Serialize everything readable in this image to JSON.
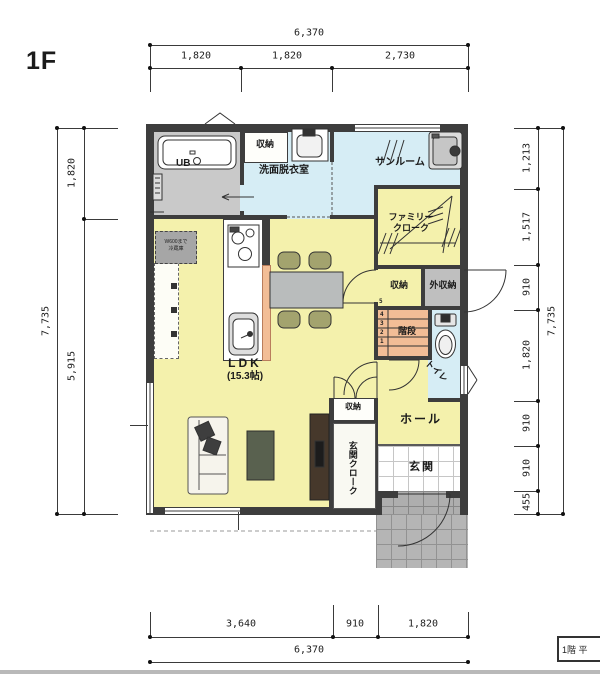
{
  "title": "1F",
  "stamp": "1階 平",
  "dims": {
    "top": {
      "total": "6,370",
      "seg": [
        "1,820",
        "1,820",
        "2,730"
      ]
    },
    "bottom": {
      "total": "6,370",
      "seg": [
        "3,640",
        "910",
        "1,820"
      ]
    },
    "left": {
      "total": "7,735",
      "seg": [
        "1,820",
        "5,915"
      ]
    },
    "right": {
      "total": "7,735",
      "seg": [
        "1,213",
        "1,517",
        "910",
        "1,820",
        "910",
        "910",
        "455"
      ]
    }
  },
  "rooms": {
    "ub": "UB",
    "storage_top": "収納",
    "washroom": "洗面脱衣室",
    "sunroom": "サンルーム",
    "family_cloak": [
      "ファミリー",
      "クローク"
    ],
    "storage_mid": "収納",
    "ext_storage": "外収納",
    "stairs": "階段",
    "toilet": "トイレ",
    "ldk": "LDK",
    "ldk_size": "(15.3帖)",
    "hall": "ホール",
    "entrance": "玄関",
    "storage_hall": "収納",
    "entrance_cloak": "玄関クローク",
    "fridge": [
      "W600まで",
      "冷蔵庫"
    ]
  },
  "stairs_numbers": [
    "1",
    "2",
    "3",
    "4",
    "5"
  ],
  "colors": {
    "room_yellow": "#f4f1ac",
    "room_blue": "#d6edf5",
    "stairs_orange": "#f2bd96",
    "storage_gray": "#bfbfbf",
    "wall": "#3d3d3d"
  }
}
